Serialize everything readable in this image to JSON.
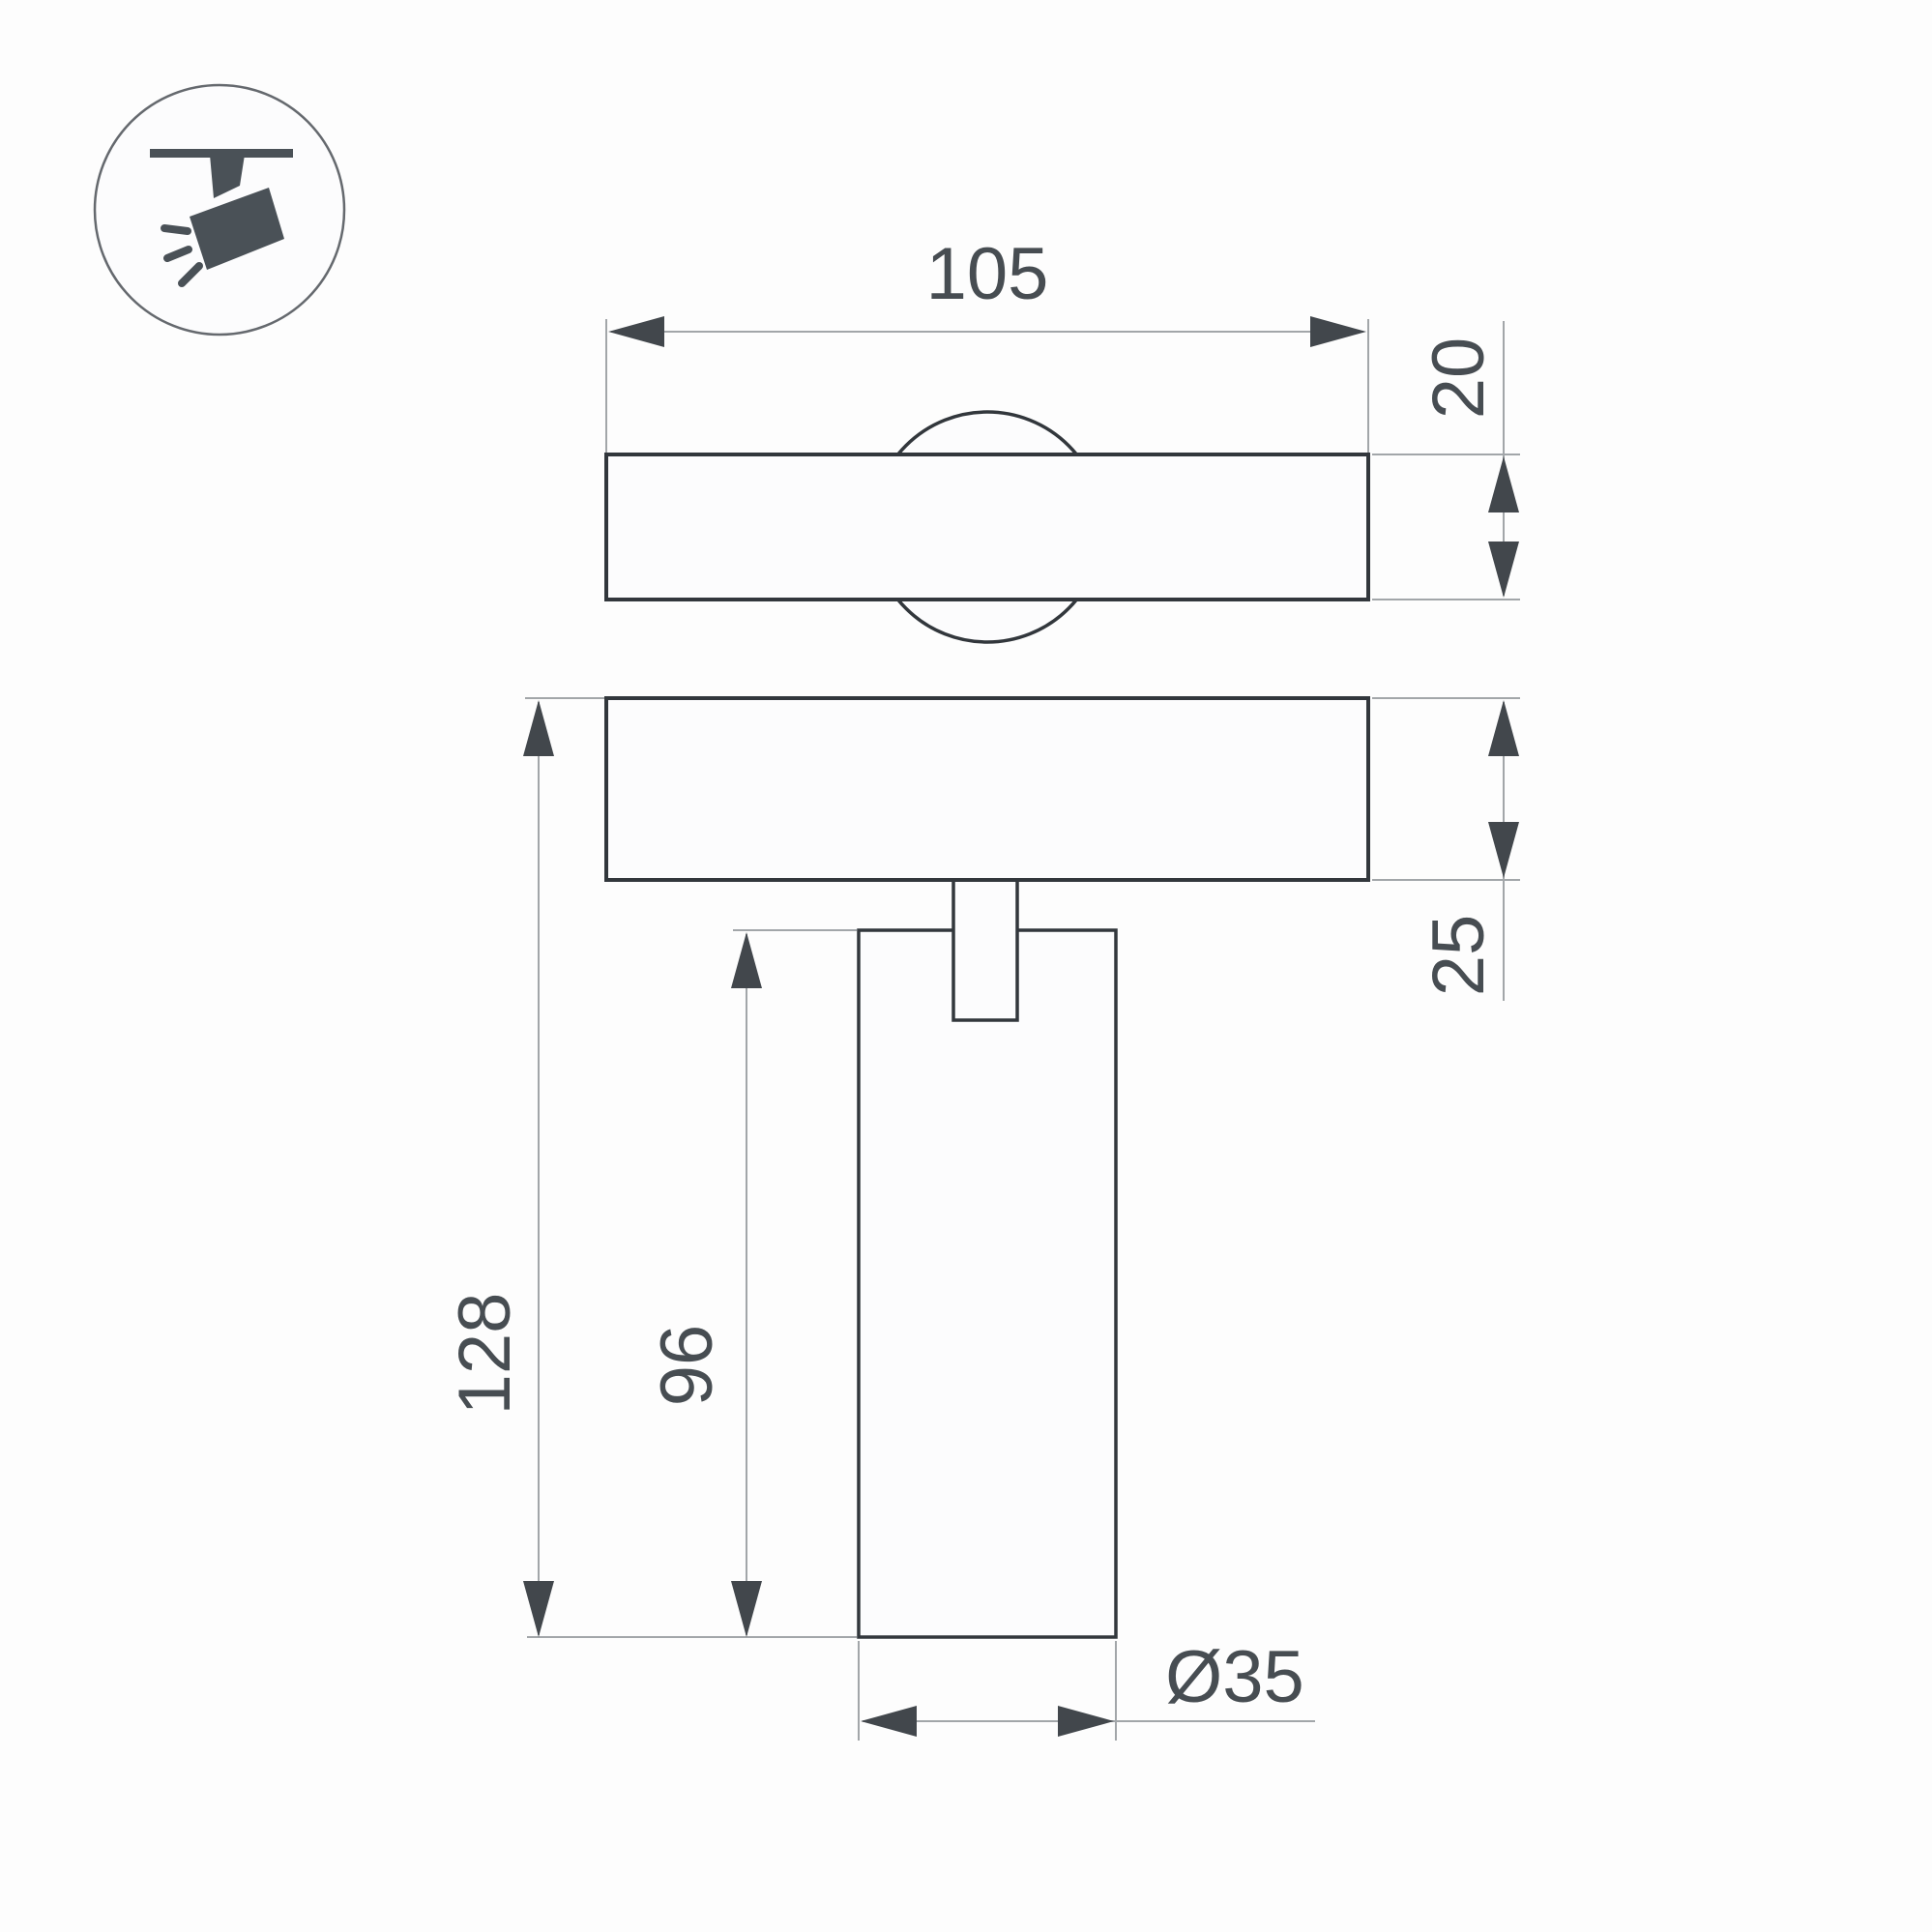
{
  "window": {
    "background": "#fdfdfd"
  },
  "icon": {
    "name": "track-spotlight-pictogram",
    "color": "#4a5157",
    "ring_color": "#65696e"
  },
  "drawing": {
    "outline_color": "#32373c",
    "thin_line_color": "#a2a6a9",
    "arrow_color": "#42474c",
    "text_color": "#474d52",
    "labels": {
      "top_width": "105",
      "track_profile_height": "20",
      "plate_thickness": "25",
      "overall_height": "128",
      "body_height": "96",
      "body_diameter": "Ø35"
    }
  }
}
